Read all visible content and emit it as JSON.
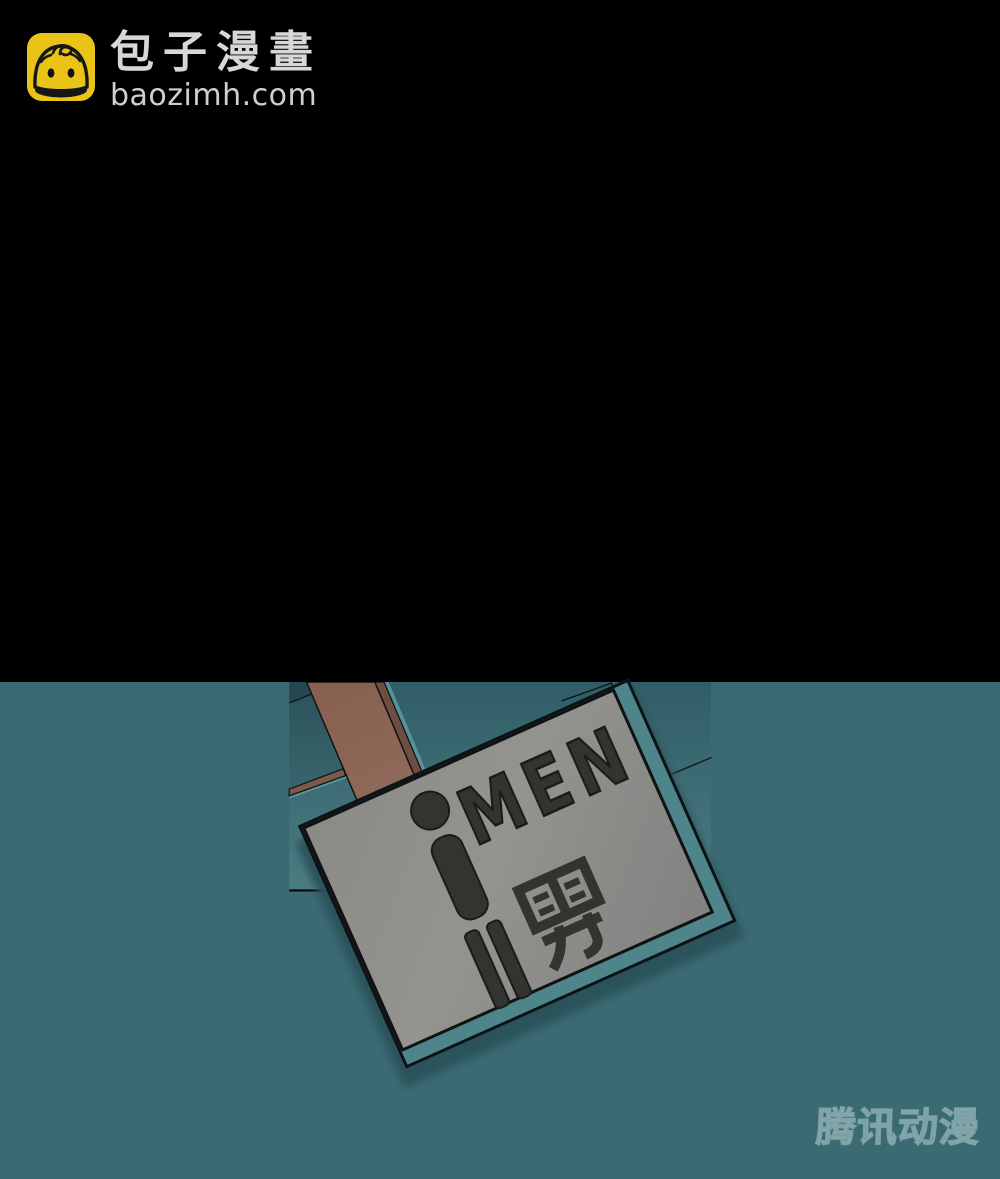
{
  "brand": {
    "name": "包子漫畫",
    "domain": "baozimh.com",
    "icon": "baozi-bun-icon",
    "icon_color": "#e9c417",
    "text_color": "#d7d7d7"
  },
  "panel": {
    "background_color": "#000000",
    "restroom_sign": {
      "label_en": "MEN",
      "label_zh": "男",
      "pictogram": "male-figure",
      "plate_color": "#8e8d8a",
      "glyph_color": "#33332f"
    },
    "watermark": {
      "text": "腾讯动漫"
    },
    "wall": {
      "tile_color": "#3f6d75",
      "tile_color_dark": "#2f575f",
      "beam_color": "#906a5b",
      "grout_color": "#0d1315",
      "highlight_color": "#579499"
    }
  }
}
